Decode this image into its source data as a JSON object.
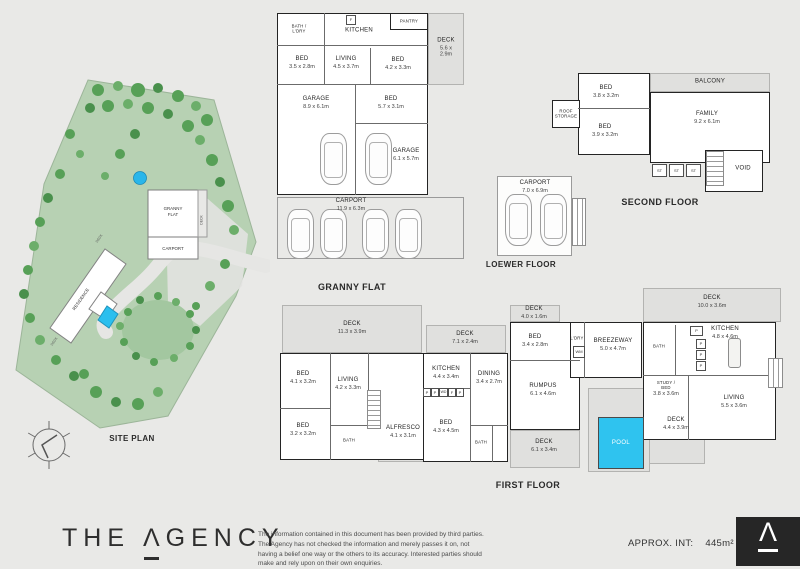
{
  "site": {
    "caption": "SITE PLAN",
    "granny_line1": "GRANNY",
    "granny_line2": "FLAT",
    "carport": "CARPORT",
    "residence": "RESIDENCE",
    "deck": "DECK"
  },
  "granny": {
    "caption": "GRANNY FLAT",
    "rooms": [
      {
        "name": "BATH /\nL'DRY",
        "dims": ""
      },
      {
        "name": "KITCHEN",
        "dims": ""
      },
      {
        "name": "PANTRY",
        "dims": ""
      },
      {
        "name": "DECK",
        "dims": "5.6 x 2.9m"
      },
      {
        "name": "BED",
        "dims": "3.5 x 2.8m"
      },
      {
        "name": "LIVING",
        "dims": "4.5 x 3.7m"
      },
      {
        "name": "BED",
        "dims": "4.2 x 3.3m"
      },
      {
        "name": "GARAGE",
        "dims": "8.9 x 6.1m"
      },
      {
        "name": "BED",
        "dims": "5.7 x 3.1m"
      },
      {
        "name": "GARAGE",
        "dims": "6.1 x 5.7m"
      },
      {
        "name": "CARPORT",
        "dims": "11.9 x 6.3m"
      },
      {
        "name": "F",
        "dims": ""
      }
    ]
  },
  "second": {
    "caption": "SECOND FLOOR",
    "rooms": [
      {
        "name": "BALCONY",
        "dims": ""
      },
      {
        "name": "BED",
        "dims": "3.8 x 3.2m"
      },
      {
        "name": "ROOF\nSTORAGE",
        "dims": ""
      },
      {
        "name": "BED",
        "dims": "3.9 x 3.2m"
      },
      {
        "name": "FAMILY",
        "dims": "9.2 x 6.1m"
      },
      {
        "name": "ST",
        "dims": ""
      },
      {
        "name": "ST",
        "dims": ""
      },
      {
        "name": "ST",
        "dims": ""
      },
      {
        "name": "VOID",
        "dims": ""
      }
    ]
  },
  "lower": {
    "caption": "LOEWER FLOOR",
    "rooms": [
      {
        "name": "CARPORT",
        "dims": "7.0 x 6.9m"
      }
    ]
  },
  "first": {
    "caption": "FIRST FLOOR",
    "wm": "WM",
    "appliances": [
      "P",
      "P",
      "WD",
      "F",
      "P"
    ],
    "pantry": [
      "P",
      "P",
      "P",
      "P"
    ],
    "rooms": [
      {
        "name": "DECK",
        "dims": "11.3 x 3.9m"
      },
      {
        "name": "BED",
        "dims": "4.1 x 3.2m"
      },
      {
        "name": "LIVING",
        "dims": "4.2 x 3.3m"
      },
      {
        "name": "BED",
        "dims": "3.2 x 3.2m"
      },
      {
        "name": "BATH",
        "dims": ""
      },
      {
        "name": "ALFRESCO",
        "dims": "4.1 x 3.1m"
      },
      {
        "name": "KITCHEN",
        "dims": "4.4 x 3.4m"
      },
      {
        "name": "BED",
        "dims": "4.3 x 4.5m"
      },
      {
        "name": "BATH",
        "dims": ""
      },
      {
        "name": "DECK",
        "dims": "7.1 x 2.4m"
      },
      {
        "name": "DINING",
        "dims": "3.4 x 2.7m"
      },
      {
        "name": "DECK",
        "dims": "4.0 x 1.6m"
      },
      {
        "name": "BED",
        "dims": "3.4 x 2.8m"
      },
      {
        "name": "RUMPUS",
        "dims": "6.1 x 4.6m"
      },
      {
        "name": "DECK",
        "dims": "6.1 x 3.4m"
      },
      {
        "name": "L'DRY",
        "dims": ""
      },
      {
        "name": "BREEZEWAY",
        "dims": "5.0 x 4.7m"
      },
      {
        "name": "BATH",
        "dims": ""
      },
      {
        "name": "KITCHEN",
        "dims": "4.8 x 4.6m"
      },
      {
        "name": "DECK",
        "dims": "10.0 x 3.6m"
      },
      {
        "name": "STUDY /\nBED",
        "dims": "3.8 x 3.6m"
      },
      {
        "name": "LIVING",
        "dims": "5.5 x 3.6m"
      },
      {
        "name": "DECK",
        "dims": "4.4 x 3.9m"
      },
      {
        "name": "POOL",
        "dims": ""
      }
    ]
  },
  "footer": {
    "brand_part1": "THE",
    "brand_part2": "Λ",
    "brand_part3": "GENCY",
    "disclaimer": "The information contained in this document has been provided by third parties. The Agency has not checked the information and merely passes it on, not having a belief one way or the others to its accuracy. Interested parties should make and rely upon on their own enquiries.",
    "approx_label": "APPROX. INT:",
    "approx_value": "445m²",
    "mark": "Λ"
  },
  "colors": {
    "pool": "#2fc3ef",
    "site_green": "#b7d1b3",
    "deck_grey": "#e0e0de"
  }
}
